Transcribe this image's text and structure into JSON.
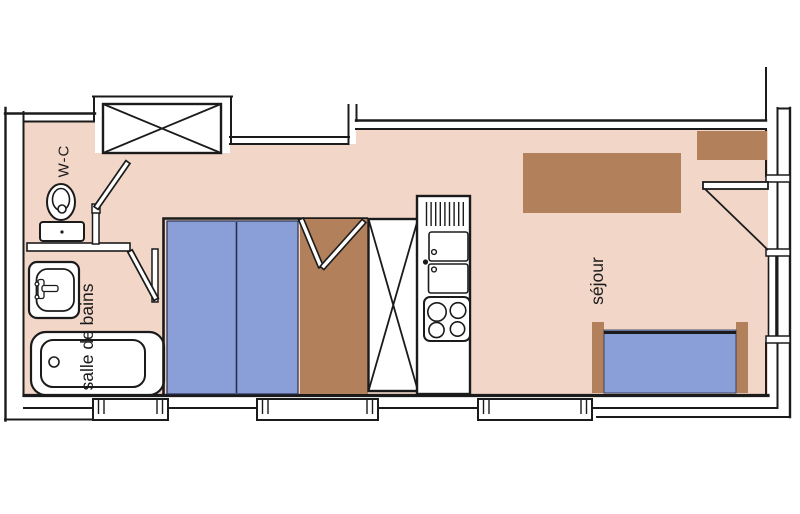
{
  "plan": {
    "title": "studio apartment floor plan",
    "labels": {
      "wc": "W-C",
      "bathroom": "salle de bains",
      "living_room": "séjour"
    },
    "colors": {
      "floor": "#f2d7c9",
      "wall": "#1b1b1b",
      "bed_blue": "#8a9ed8",
      "furniture_brown": "#b2805a",
      "fixture_white": "#ffffff",
      "background": "#ffffff"
    }
  }
}
